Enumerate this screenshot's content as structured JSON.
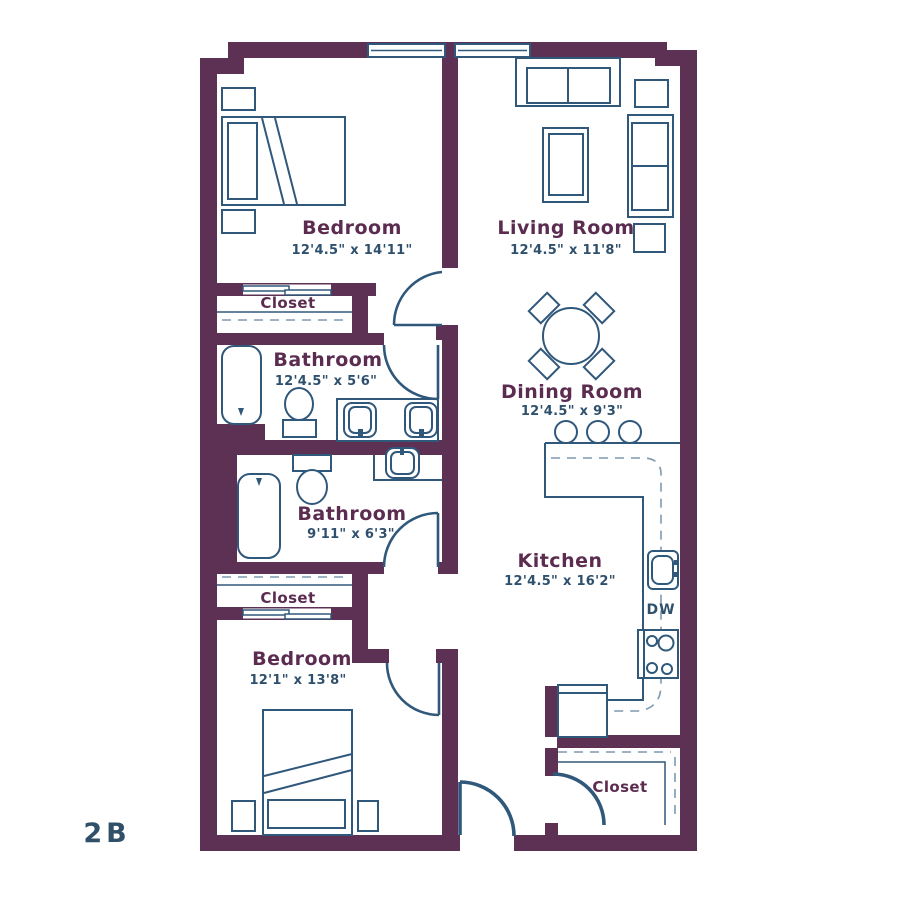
{
  "plan": {
    "unit_label": "2B",
    "rooms": {
      "bedroom1": {
        "name": "Bedroom",
        "dims": "12'4.5\" x 14'11\""
      },
      "living": {
        "name": "Living Room",
        "dims": "12'4.5\" x 11'8\""
      },
      "bathroom1": {
        "name": "Bathroom",
        "dims": "12'4.5\" x 5'6\""
      },
      "bathroom2": {
        "name": "Bathroom",
        "dims": "9'11\" x 6'3\""
      },
      "dining": {
        "name": "Dining Room",
        "dims": "12'4.5\" x 9'3\""
      },
      "kitchen": {
        "name": "Kitchen",
        "dims": "12'4.5\" x 16'2\""
      },
      "bedroom2": {
        "name": "Bedroom",
        "dims": "12'1\" x 13'8\""
      },
      "closet_bedroom1": {
        "name": "Closet"
      },
      "closet_hall": {
        "name": "Closet"
      },
      "closet_entry": {
        "name": "Closet"
      }
    },
    "appliances": {
      "dishwasher": "DW"
    },
    "colors": {
      "wall": "#5C3153",
      "fixture_line": "#30587B",
      "room_label_text": "#5B2C50",
      "dimension_text": "#2F506C",
      "dashed_guide": "#7D99B0",
      "background": "#FFFFFF"
    }
  }
}
